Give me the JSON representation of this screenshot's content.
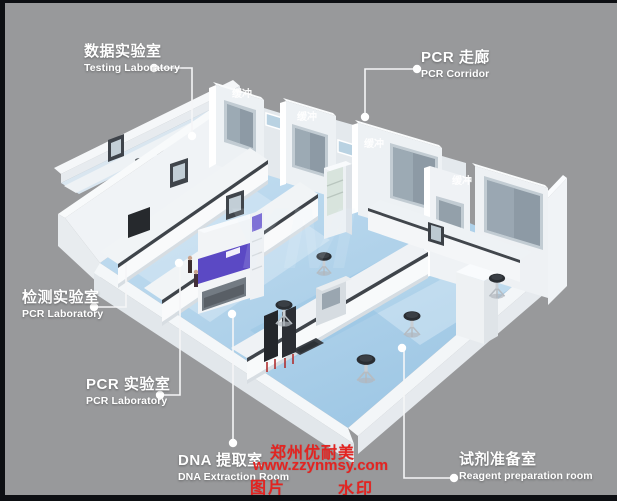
{
  "frame": {
    "color": "#0d0f13"
  },
  "background_color": "#98999b",
  "rooms": {
    "testing_lab": {
      "zh": "数据实验室",
      "en": "Testing Laboratory"
    },
    "pcr_corridor": {
      "zh": "PCR 走廊",
      "en": "PCR Corridor"
    },
    "inspection_lab": {
      "zh": "检测实验室",
      "en": "PCR Laboratory"
    },
    "pcr_lab": {
      "zh": "PCR 实验室",
      "en": "PCR Laboratory"
    },
    "dna_extraction": {
      "zh": "DNA 提取室",
      "en": "DNA Extraction Room"
    },
    "reagent_prep": {
      "zh": "试剂准备室",
      "en": "Reagent preparation room"
    },
    "buffer": {
      "zh": "缓冲"
    }
  },
  "watermark": {
    "company": "郑州优耐美",
    "website": "www.zzynmsy.com",
    "label_image": "图片",
    "label_watermark": "水印",
    "logo": "YM",
    "color": "#e32421"
  },
  "palette": {
    "floor_blue": "#aecfe9",
    "wall_white": "#f1f4f6",
    "window_glass": "#8d9aa5",
    "cabinet_purple": "#5b49c4",
    "label_text": "#ffffff"
  }
}
